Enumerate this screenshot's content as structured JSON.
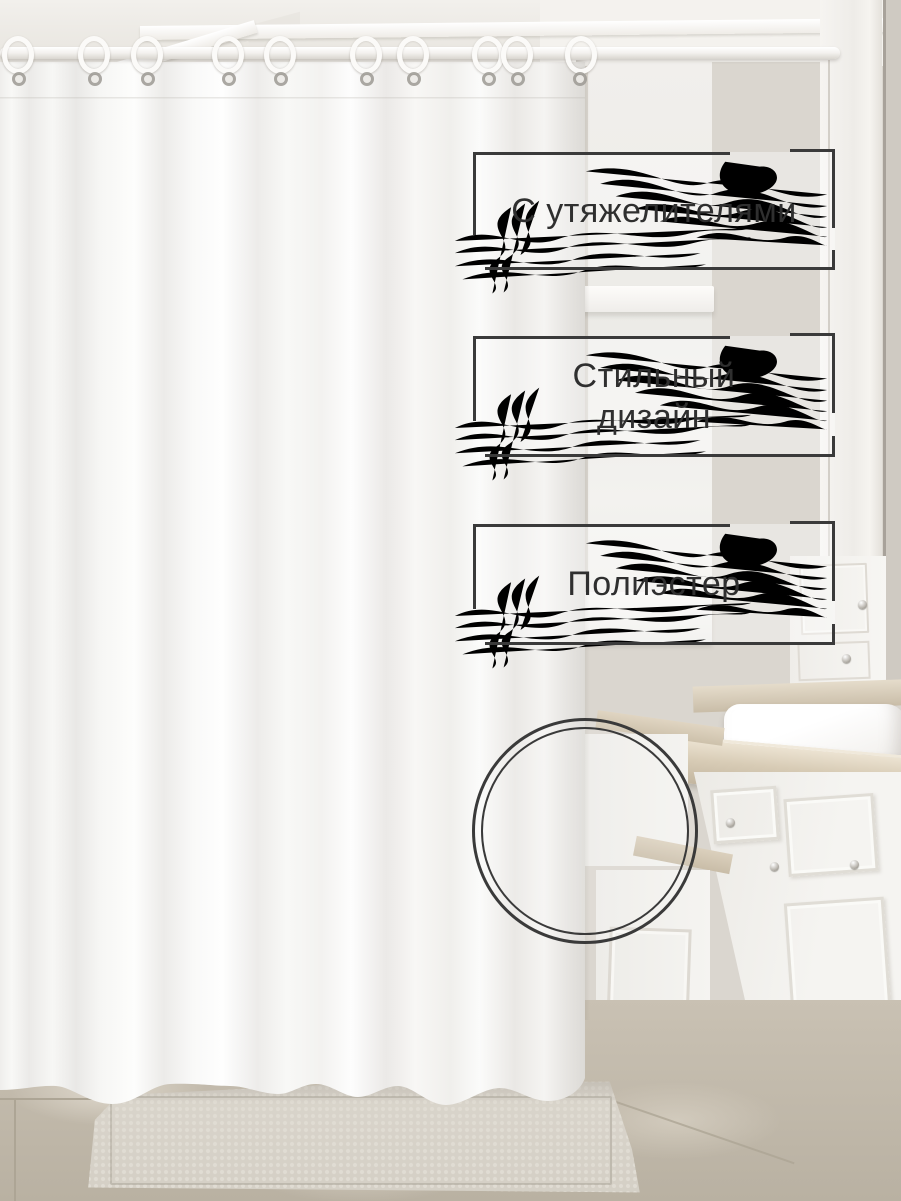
{
  "meta": {
    "kind": "marketplace product photo",
    "scene": "white shower curtain hanging on a rod in a light beige bathroom with white vanity cabinets, marble countertop, towel, tiled floor and textured bath mat"
  },
  "badges": [
    {
      "id": "weights",
      "label": "С утяжелителями",
      "lines": [
        "С утяжелителями"
      ]
    },
    {
      "id": "design",
      "label": "Стильный дизайн",
      "lines": [
        "Стильный",
        "дизайн"
      ]
    },
    {
      "id": "material",
      "label": "Полиэстер",
      "lines": [
        "Полиэстер"
      ]
    }
  ],
  "decorations": {
    "swirl": "marble-contour-lines",
    "inset": "fabric-zoom-double-circle",
    "hooks_count": 10
  },
  "colors": {
    "frame": "#3a3a3a",
    "text": "#2f2f2f",
    "swirl": "#b2afa9",
    "wall": "#dad6cf",
    "ceiling": "#e7e4de",
    "window": "#efede9",
    "counterDark": "#c3b6a0",
    "cabinet": "#f3f2ee",
    "floor": "#c9c1b3",
    "grout": "#ada595",
    "mat": "#d4cfc5",
    "metal": "#9d9a94",
    "rod": "#fbfaf8"
  }
}
